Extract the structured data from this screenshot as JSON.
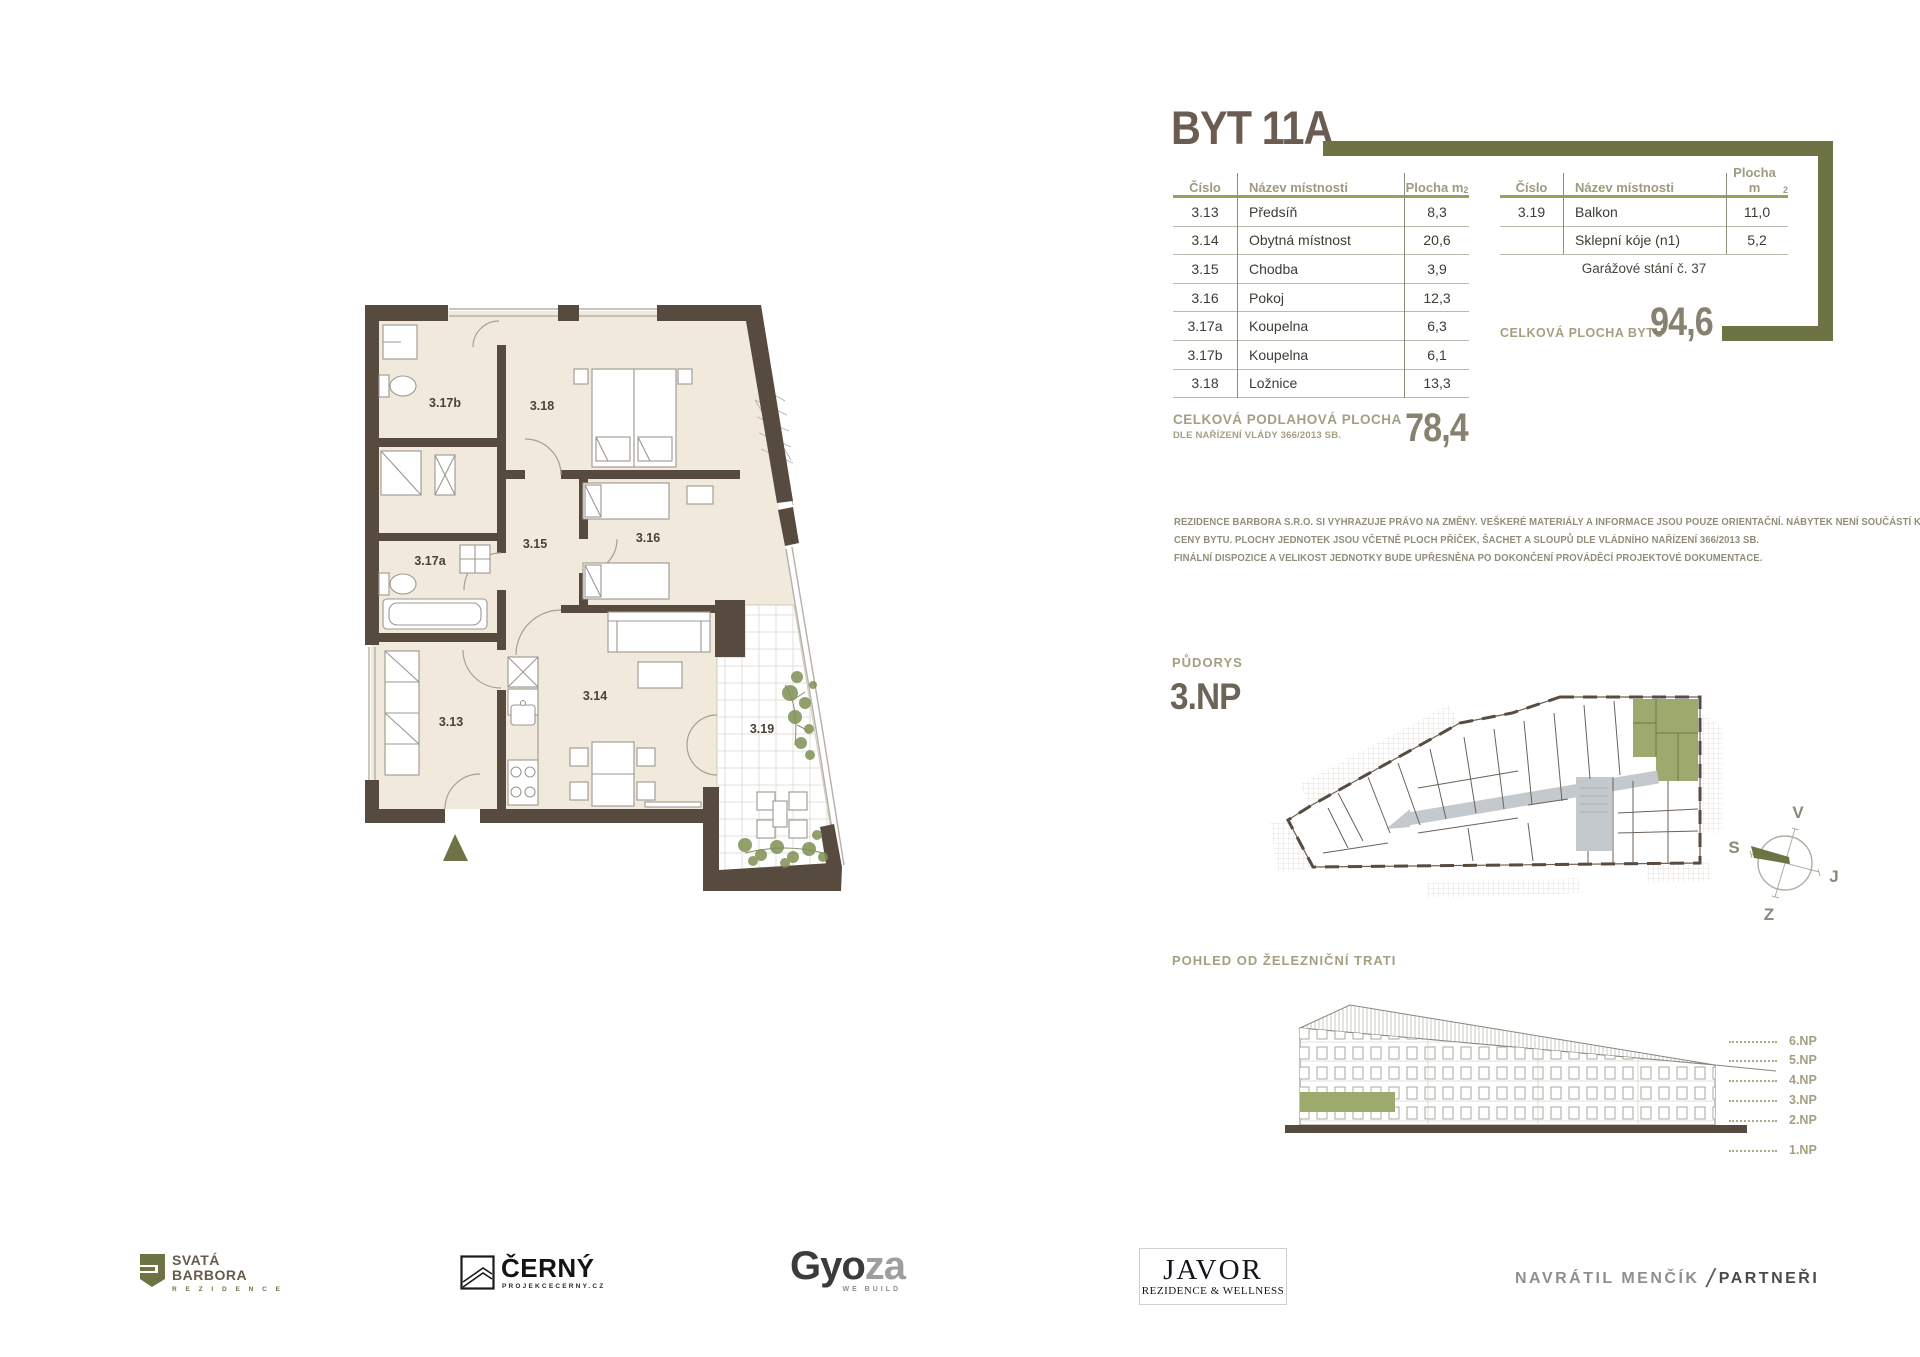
{
  "title": "BYT 11A",
  "room_table": {
    "col_num": "Číslo",
    "col_name": "Název místnosti",
    "col_area": "Plocha m",
    "col_area_sup": "2",
    "rows": [
      {
        "num": "3.13",
        "name": "Předsíň",
        "area": "8,3"
      },
      {
        "num": "3.14",
        "name": "Obytná místnost",
        "area": "20,6"
      },
      {
        "num": "3.15",
        "name": "Chodba",
        "area": "3,9"
      },
      {
        "num": "3.16",
        "name": "Pokoj",
        "area": "12,3"
      },
      {
        "num": "3.17a",
        "name": "Koupelna",
        "area": "6,3"
      },
      {
        "num": "3.17b",
        "name": "Koupelna",
        "area": "6,1"
      },
      {
        "num": "3.18",
        "name": "Ložnice",
        "area": "13,3"
      }
    ]
  },
  "extras_table": {
    "col_num": "Číslo",
    "col_name": "Název místnosti",
    "col_area": "Plocha m",
    "col_area_sup": "2",
    "rows": [
      {
        "num": "3.19",
        "name": "Balkon",
        "area": "11,0"
      },
      {
        "num": "",
        "name": "Sklepní kóje (n1)",
        "area": "5,2"
      }
    ],
    "note": "Garážové stání č. 37"
  },
  "totals": {
    "floor_label": "CELKOVÁ PODLAHOVÁ  PLOCHA",
    "floor_sublabel": "DLE NAŘÍZENÍ VLÁDY 366/2013 SB.",
    "floor_value": "78,4",
    "unit_label": "CELKOVÁ PLOCHA BYTU",
    "unit_value": "94,6"
  },
  "disclaimer": {
    "line1": "REZIDENCE BARBORA S.R.O. SI VYHRAZUJE PRÁVO NA ZMĚNY. VEŠKERÉ MATERIÁLY A INFORMACE JSOU POUZE ORIENTAČNÍ. NÁBYTEK NENÍ SOUČÁSTÍ KUPNÍ",
    "line2": "CENY BYTU. PLOCHY JEDNOTEK JSOU VČETNĚ PLOCH PŘÍČEK, ŠACHET A SLOUPŮ DLE VLÁDNÍHO NAŘÍZENÍ 366/2013 SB.",
    "line3": "FINÁLNÍ DISPOZICE A VELIKOST JEDNOTKY BUDE UPŘESNĚNA PO DOKONČENÍ PROVÁDĚCÍ PROJEKTOVÉ DOKUMENTACE."
  },
  "floor_plan": {
    "rooms": {
      "r313": "3.13",
      "r314": "3.14",
      "r315": "3.15",
      "r316": "3.16",
      "r317a": "3.17a",
      "r317b": "3.17b",
      "r318": "3.18",
      "r319": "3.19"
    }
  },
  "site_plan": {
    "label": "PŮDORYS",
    "floor": "3.NP"
  },
  "compass": {
    "top": "V",
    "left": "S",
    "right": "J",
    "bottom": "Z"
  },
  "elevation": {
    "label": "POHLED OD ŽELEZNIČNÍ TRATI",
    "floors": [
      "6.NP",
      "5.NP",
      "4.NP",
      "3.NP",
      "2.NP",
      "1.NP"
    ]
  },
  "footer": {
    "barbora": {
      "line1": "SVATÁ",
      "line2": "BARBORA",
      "sub": "R E Z I D E N C E"
    },
    "cerny": {
      "name": "ČERNÝ",
      "sub": "PROJEKCECERNY.CZ"
    },
    "gyoza": {
      "part1": "Gyo",
      "part2": "za",
      "sub": "WE BUILD"
    },
    "javor": {
      "name": "JAVOR",
      "sub": "REZIDENCE & WELLNESS"
    },
    "navratil": {
      "name": "NAVRÁTIL MENČÍK",
      "slash": "/",
      "partners": "PARTNEŘI"
    }
  },
  "colors": {
    "accent_olive": "#6d7344",
    "wall_brown": "#574a3f",
    "floor_beige": "#f2e9dd",
    "khaki_label": "#a49f83",
    "highlight_green": "#9daa6e",
    "corridor_gray": "#c3c9cc"
  }
}
